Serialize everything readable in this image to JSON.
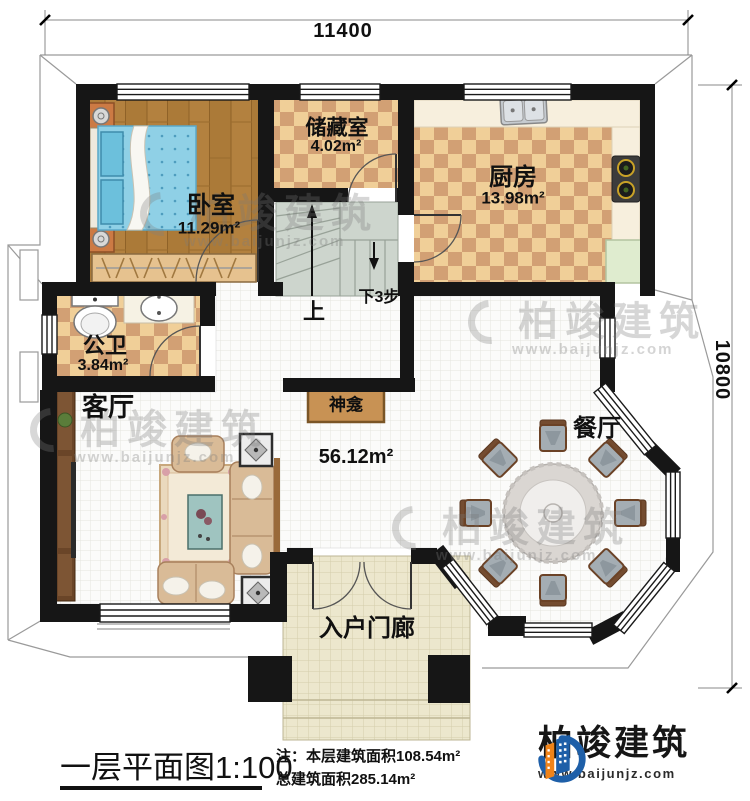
{
  "dimensions": {
    "top": "11400",
    "right": "10800"
  },
  "rooms": {
    "bedroom": {
      "name": "卧室",
      "area": "11.29m²"
    },
    "storage": {
      "name": "储藏室",
      "area": "4.02m²"
    },
    "kitchen": {
      "name": "厨房",
      "area": "13.98m²"
    },
    "bathroom": {
      "name": "公卫",
      "area": "3.84m²"
    },
    "living": {
      "name": "客厅"
    },
    "dining": {
      "name": "餐厅"
    },
    "porch": {
      "name": "入户门廊"
    },
    "shrine": {
      "name": "神龛"
    },
    "living_dining_area": "56.12m²"
  },
  "stairs": {
    "up": "上",
    "down": "下3步"
  },
  "footer": {
    "title": "一层平面图",
    "scale": "1:100",
    "note1": "注：本层建筑面积108.54m²",
    "note2": "总建筑面积285.14m²"
  },
  "brand": {
    "name": "柏竣建筑",
    "url": "www.baijunjz.com"
  },
  "watermark": {
    "text": "柏竣建筑",
    "url": "www.baijunjz.com"
  },
  "colors": {
    "wall": "#161616",
    "wood_floor": "#b3813f",
    "checker_light": "#f0cf98",
    "checker_dark": "#d2a074",
    "brand_blue": "#1e5fa8",
    "brand_orange": "#ef8319"
  }
}
